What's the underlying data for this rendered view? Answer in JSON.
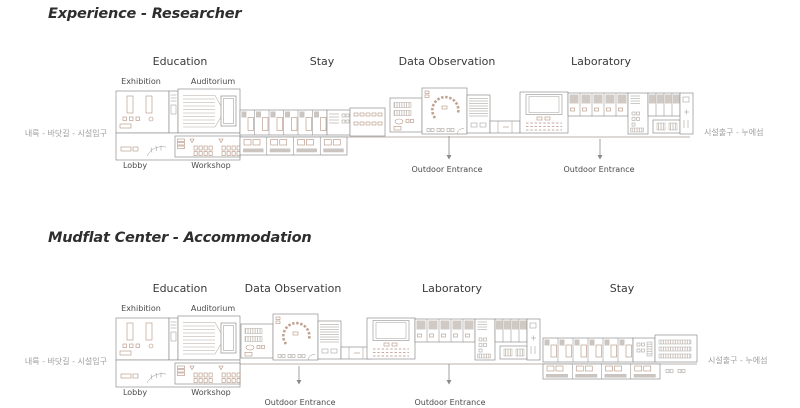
{
  "colors": {
    "wall": "#8f8f8f",
    "furniture_accent": "#b5907f",
    "title_text": "#2e2e2e",
    "label_text": "#3a3a3a",
    "muted_text": "#9e9e9e"
  },
  "plans": [
    {
      "title": "Experience - Researcher",
      "sections": [
        {
          "label": "Education"
        },
        {
          "label": "Stay"
        },
        {
          "label": "Data Observation"
        },
        {
          "label": "Laboratory"
        }
      ],
      "rooms_top": [
        {
          "label": "Exhibition"
        },
        {
          "label": "Auditorium"
        }
      ],
      "rooms_bottom": [
        {
          "label": "Lobby"
        },
        {
          "label": "Workshop"
        }
      ],
      "route_left": "내륙 - 바닷길 - 시설입구",
      "route_right": "시설출구 - 누에섬",
      "entrances": [
        {
          "label": "Outdoor Entrance"
        },
        {
          "label": "Outdoor Entrance"
        }
      ]
    },
    {
      "title": "Mudflat Center - Accommodation",
      "sections": [
        {
          "label": "Education"
        },
        {
          "label": "Data Observation"
        },
        {
          "label": "Laboratory"
        },
        {
          "label": "Stay"
        }
      ],
      "rooms_top": [
        {
          "label": "Exhibition"
        },
        {
          "label": "Auditorium"
        }
      ],
      "rooms_bottom": [
        {
          "label": "Lobby"
        },
        {
          "label": "Workshop"
        }
      ],
      "route_left": "내륙 - 바닷길 - 시설입구",
      "route_right": "시설출구 - 누에섬",
      "entrances": [
        {
          "label": "Outdoor Entrance"
        },
        {
          "label": "Outdoor Entrance"
        }
      ]
    }
  ]
}
